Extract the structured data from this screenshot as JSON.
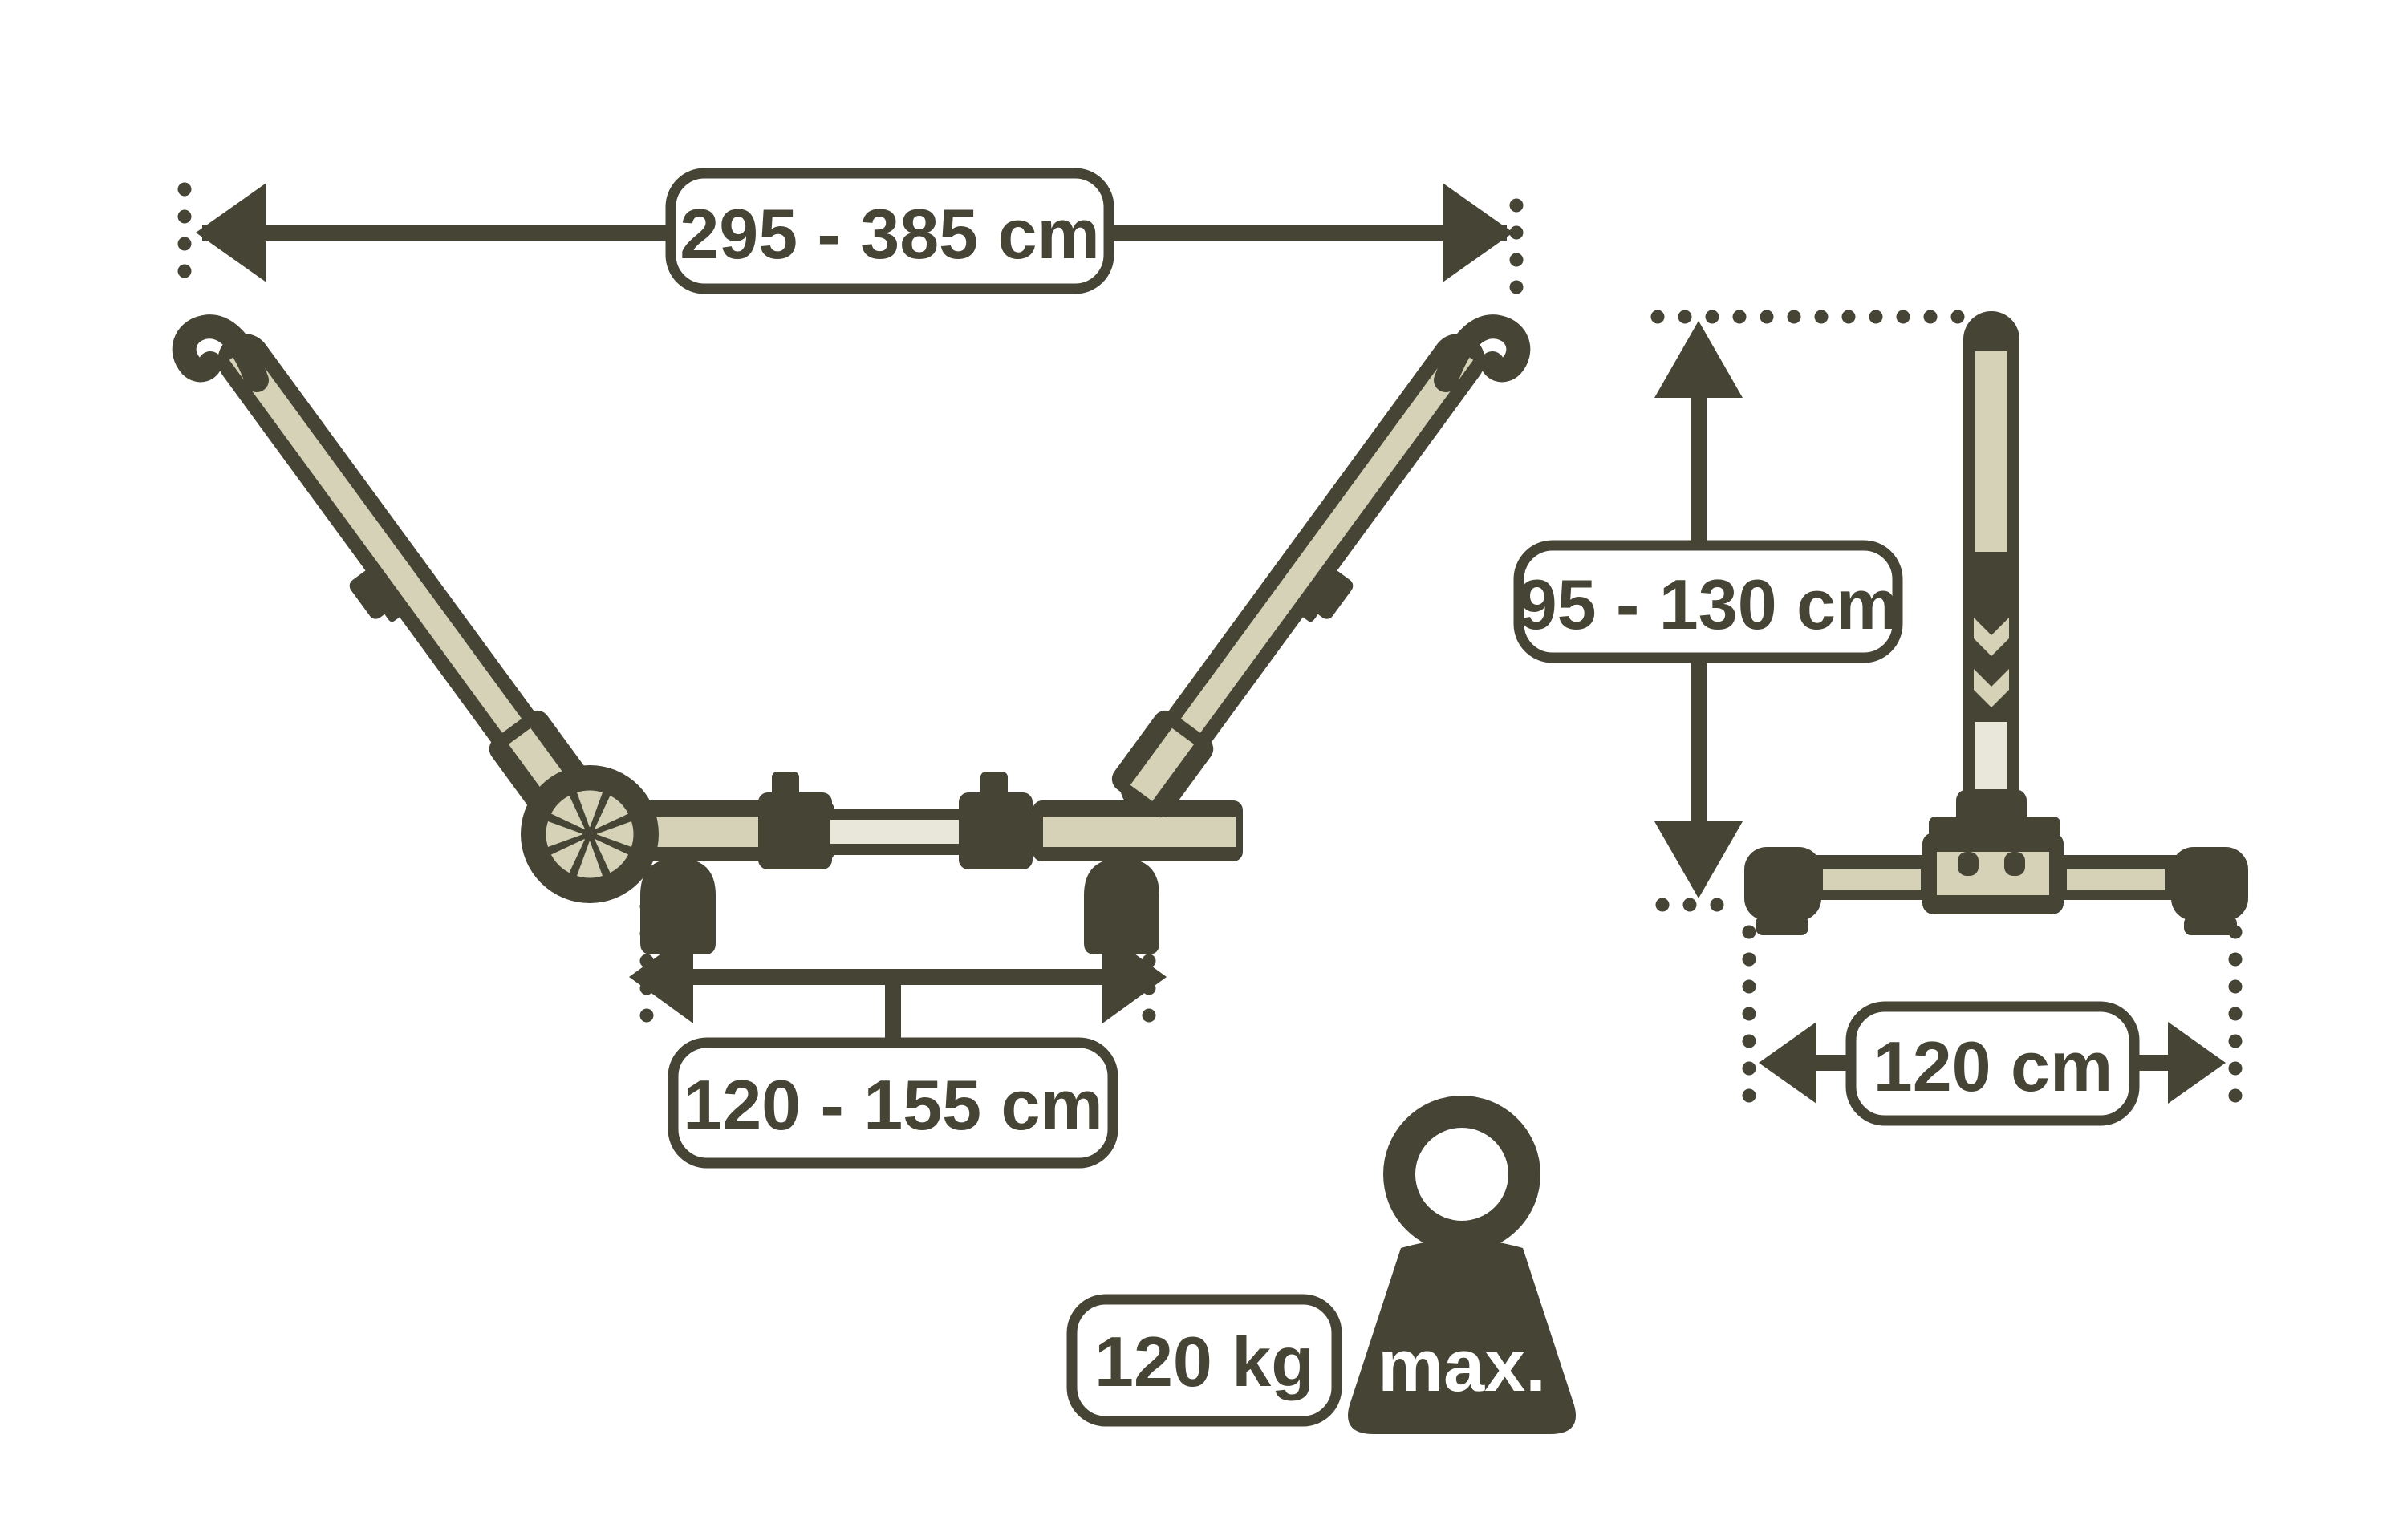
{
  "diagram": {
    "type": "hammock-stand dimension diagram",
    "labels": {
      "spread": "295 - 385 cm",
      "base_length": "120 - 155 cm",
      "height": "95 - 130 cm",
      "depth": "120 cm",
      "max_weight": "120 kg",
      "max_text": "max."
    }
  },
  "colors": {
    "dark": "#454435",
    "beige": "#d6d2b8",
    "beige_light": "#e9e6da",
    "dot_light": "#a8a79b",
    "background": "#ffffff"
  }
}
